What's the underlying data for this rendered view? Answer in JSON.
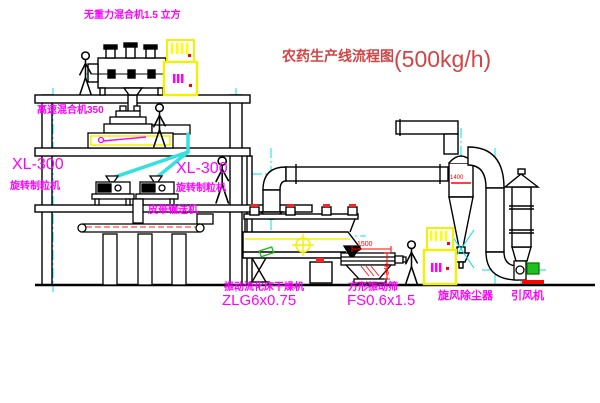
{
  "title": {
    "name": "农药生产线流程图",
    "capacity": "(500kg/h)"
  },
  "equipment_labels": {
    "gravity_mixer": "无重力混合机1.5 立方",
    "high_speed_mixer": "高速混合机350",
    "granulator_left_model": "XL-300",
    "granulator_left_name": "旋转制粒机",
    "granulator_right_model": "XL-300",
    "granulator_right_name": "旋转制粒机",
    "belt_conveyor": "皮带输送机",
    "dryer_name": "振动流化床干燥机",
    "dryer_model": "ZLG6x0.75",
    "sieve_name": "方形振动筛",
    "sieve_model": "FS0.6x1.5",
    "cyclone": "旋风除尘器",
    "fan": "引风机"
  },
  "dimensions": {
    "sieve_length": "1500",
    "sieve_height": "340",
    "cyclone_diameter": "1400"
  },
  "colors": {
    "label_magenta": "#ff00ff",
    "title_red": "#d04545",
    "dimension_red": "#ff0000",
    "centerline_cyan": "#00e0e0",
    "cabinet_yellow": "#ffff00",
    "motor_green": "#1fbf1f",
    "line_black": "#000000"
  }
}
